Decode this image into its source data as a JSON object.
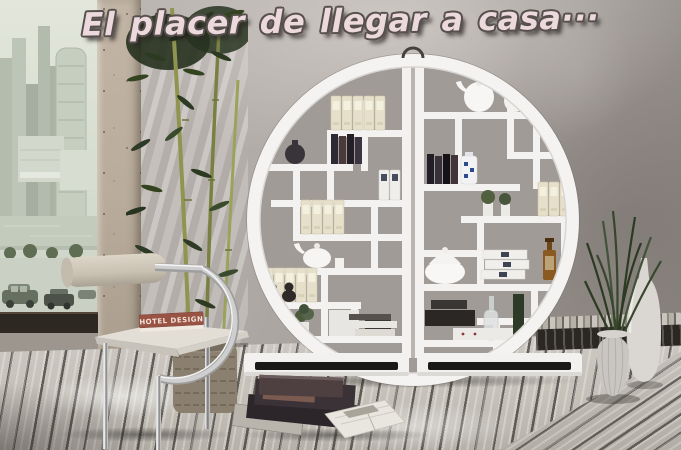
{
  "headline": {
    "text": "El placer de llegar a casa···"
  },
  "chair": {
    "book_title": "HOTEL DESIGN"
  },
  "palette": {
    "wall": "#ada7a2",
    "wall_shadow": "#8f8984",
    "floor_plank": "#c8c4bc",
    "floor_gap": "#2e2b27",
    "shelf_white": "#f3f2f0",
    "shelf_back": "#a19b97",
    "plinth_recess": "#191918",
    "city_tint": "#ccd3c6",
    "bamboo_leaf": "#2c3a22",
    "bamboo_stem": "#8f944f",
    "cushion": "#d5cec0",
    "chrome": "#c9c9c9",
    "basket": "#8b8070",
    "book_cover": "#995344",
    "amber_bottle": "#8a5a20",
    "headline_fill": "#ecd9de",
    "headline_outline": "#57504d"
  }
}
